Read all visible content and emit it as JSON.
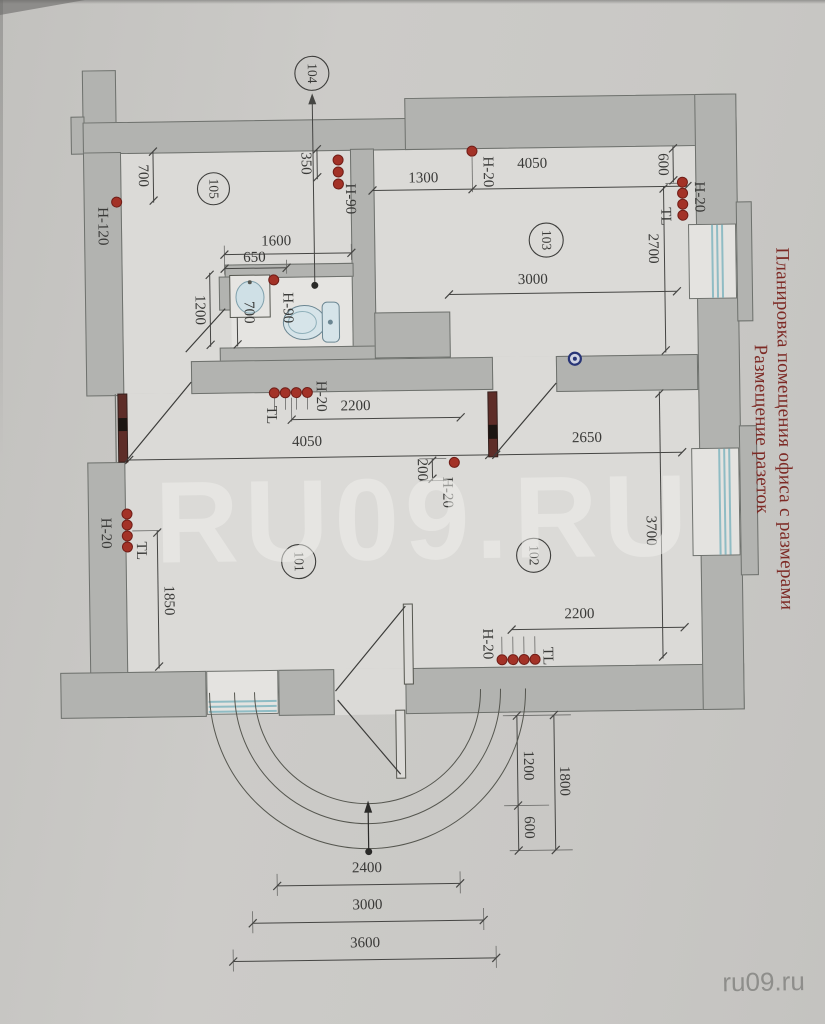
{
  "title": {
    "line1": "Планировка помещения офиса с размерами",
    "line2": "Размещение разеток"
  },
  "watermark": {
    "large": "RU09.RU",
    "small": "ru09.ru"
  },
  "rooms": {
    "r101": "101",
    "r102": "102",
    "r103": "103",
    "r104": "104",
    "r105": "105"
  },
  "dimensions": {
    "top700": "700",
    "v350": "350",
    "w1600": "1600",
    "w650": "650",
    "bath1200": "1200",
    "bath700": "700",
    "r103_1300": "1300",
    "r103_4050": "4050",
    "r103_3000": "3000",
    "r103_600": "600",
    "r103_2700": "2700",
    "hall_2200": "2200",
    "hall_4050": "4050",
    "r102_2650": "2650",
    "door_200": "200",
    "r102_3700": "3700",
    "r101_1850": "1850",
    "r102_2200": "2200",
    "ent_1200": "1200",
    "ent_1800": "1800",
    "ent_600": "600",
    "b2400": "2400",
    "b3000": "3000",
    "b3600": "3600"
  },
  "sockets": {
    "h120": "Н-120",
    "h90_105": "Н-90",
    "h90_bath": "Н-90",
    "h20_103top": "Н-20",
    "h20_103right": "Н-20",
    "tl_103": "TL",
    "h20_hall": "Н-20",
    "tl_hall": "TL",
    "h20_door": "Н-20",
    "h20_101": "Н-20",
    "tl_101": "TL",
    "h20_102": "Н-20",
    "tl_102": "TL"
  },
  "colors": {
    "socket_red": "#a33227",
    "title_red": "#7d2a25",
    "window_cyan": "#8fbcc4",
    "junction_blue": "#283577",
    "door_leaf": "#5e2d28",
    "wall_gray": "#b2b3b0"
  }
}
